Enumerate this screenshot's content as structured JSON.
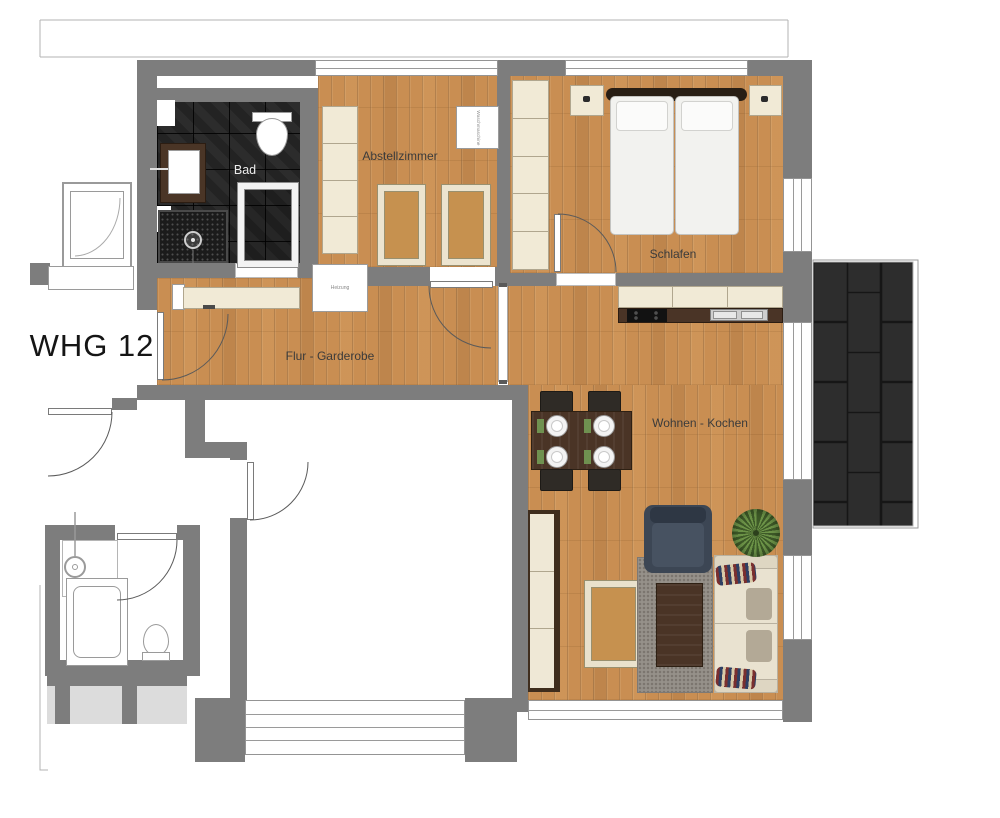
{
  "apartment": {
    "label": "WHG 12"
  },
  "rooms": {
    "bad": "Bad",
    "abstellzimmer": "Abstellzimmer",
    "schlafen": "Schlafen",
    "flur": "Flur - Garderobe",
    "wohnen": "Wohnen - Kochen"
  },
  "appliances": {
    "washing_machine": "Waschmaschine",
    "heater": "Heizung"
  },
  "colors": {
    "wall": "#7d7d7d",
    "wood_floor": "#c98e52",
    "bath_tile": "#232323",
    "balcony_tile": "#2d2d2d",
    "furniture_cream": "#f1ead6",
    "armchair_dark": "#3c4654"
  }
}
